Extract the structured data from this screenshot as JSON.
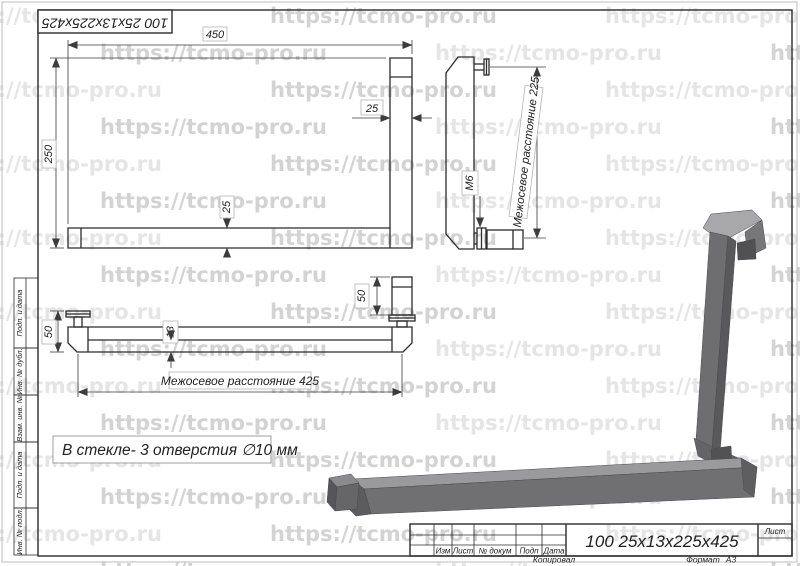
{
  "watermark": {
    "text": "https://tcmo-pro.ru",
    "color_light": "#e5e5e5",
    "color_dark": "#d3d3d3"
  },
  "designation_stamp": "100 25x13x225x425",
  "views": {
    "front": {
      "dim_length": "450",
      "dim_height": "250",
      "dim_bar_width": "25",
      "dim_bar_thickness": "25"
    },
    "side": {
      "dim_axes_distance": "Межосевое расстояние 225",
      "thread_label": "М6"
    },
    "top": {
      "dim_axes_distance": "Межосевое расстояние 425",
      "dim_block_left": "50",
      "dim_block_right": "50",
      "dim_thickness": "13"
    },
    "note": "В стекле- 3 отверстия ∅10 мм"
  },
  "title_block": {
    "designation": "100 25x13x225x425",
    "col_izm": "Изм",
    "col_list": "Лист",
    "col_doc": "№ докум",
    "col_podp": "Подп",
    "col_data": "Дата",
    "sheet_label": "Лист",
    "copied_label": "Копировал",
    "format_label": "Формат",
    "format_value": "А3"
  },
  "side_stamps": [
    "Подп. и дата",
    "Инв. № дубл.",
    "Взам. инв. №",
    "Подп. и дата",
    "Инв. № подл."
  ],
  "colors": {
    "line": "#2b2b2b",
    "handle_front": "#707073",
    "handle_side": "#59595c",
    "handle_top": "#9a9a9c",
    "handle_cap": "#a8a8aa",
    "handle_dark": "#525255"
  }
}
